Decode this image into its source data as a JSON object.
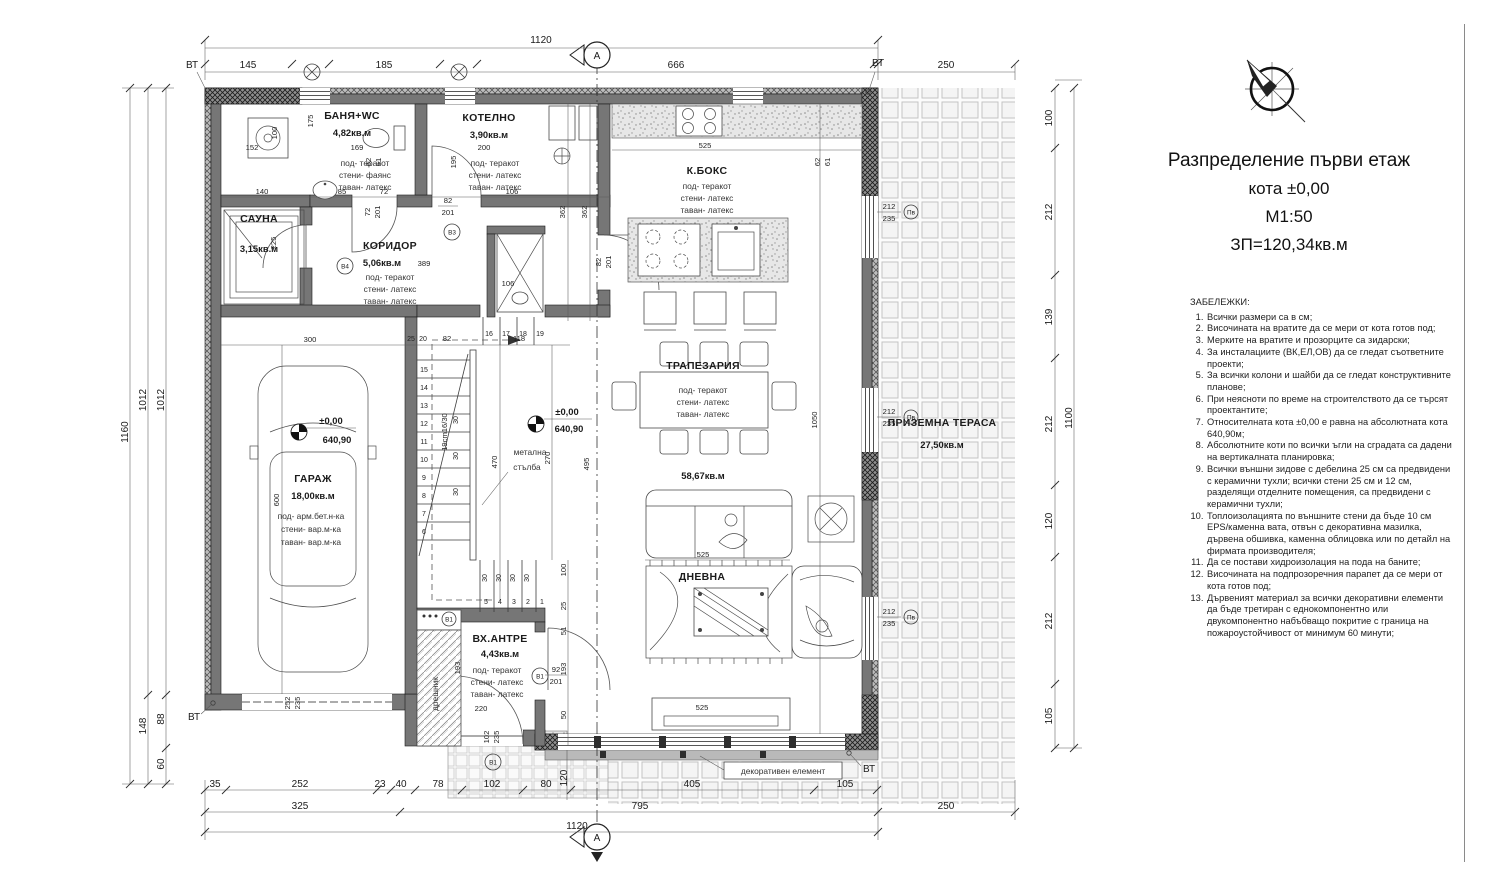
{
  "sheet": {
    "title1": "Разпределение първи етаж",
    "title2": "кота ±0,00",
    "title3": "М1:50",
    "title4": "ЗП=120,34кв.м"
  },
  "notes": {
    "heading": "ЗАБЕЛЕЖКИ:",
    "items": [
      "Всички размери са в см;",
      "Височината на вратите да се мери от кота готов под;",
      "Мерките на вратите и прозорците са зидарски;",
      "За инсталациите (ВК,ЕЛ,ОВ) да се гледат съответните проекти;",
      "За всички колони и шайби да се гледат конструктивните планове;",
      "При неясноти по време на строителството да се търсят проектантите;",
      "Относителната кота ±0,00 е равна на абсолютната кота 640,90м;",
      "Абсолютните коти по всички ъгли на сградата са дадени на вертикалната планировка;",
      "Всички външни зидове с дебелина 25 см са предвидени с керамични тухли; всички стени 25 см и 12 см, разделящи отделните помещения, са предвидени с керамични тухли;",
      "Топлоизолацията по външните стени да бъде 10 см EPS/каменна вата, отвън с декоративна мазилка, дървена обшивка, каменна облицовка или по детайл на фирмата производителя;",
      "Да се постави хидроизолация на пода на баните;",
      "Височината на подпрозоречния парапет да се мери от кота готов под;",
      "Дървеният материал за всички декоративни елементи да бъде третиран с еднокомпонентно или двукомпонентно набъбващо покритие с граница на пожароустойчивост от минимум 60 минути;"
    ]
  },
  "rooms": {
    "banya": {
      "name": "БАНЯ+WC",
      "area": "4,82кв.м",
      "f1": "под- теракот",
      "f2": "стени- фаянс",
      "f3": "таван- латекс"
    },
    "kotelno": {
      "name": "КОТЕЛНО",
      "area": "3,90кв.м",
      "f1": "под- теракот",
      "f2": "стени- латекс",
      "f3": "таван- латекс"
    },
    "sauna": {
      "name": "САУНА",
      "area": "3,15кв.м"
    },
    "koridor": {
      "name": "КОРИДОР",
      "area": "5,06кв.м",
      "extra": "389",
      "f1": "под- теракот",
      "f2": "стени- латекс",
      "f3": "таван- латекс"
    },
    "kboks": {
      "name": "К.БОКС",
      "f1": "под- теракот",
      "f2": "стени- латекс",
      "f3": "таван- латекс"
    },
    "trapezaria": {
      "name": "ТРАПЕЗАРИЯ",
      "f1": "под- теракот",
      "f2": "стени- латекс",
      "f3": "таван- латекс"
    },
    "living_area": "58,67кв.м",
    "dnevna": {
      "name": "ДНЕВНА"
    },
    "antre": {
      "name": "ВХ.АНТРЕ",
      "area": "4,43кв.м",
      "d220": "220",
      "f1": "под- теракот",
      "f2": "стени- латекс",
      "f3": "таван- латекс"
    },
    "garage": {
      "name": "ГАРАЖ",
      "area": "18,00кв.м",
      "f1": "под- арм.бет.н-ка",
      "f2": "стени- вар.м-ка",
      "f3": "таван- вар.м-ка"
    },
    "terasa": {
      "name": "ПРИЗЕМНА ТЕРАСА",
      "area": "27,50кв.м"
    }
  },
  "labels": {
    "stair1": "метална",
    "stair2": "стълба",
    "stair_spec": "19cm16/30",
    "closet": "дрешник",
    "decor": "декоративен елемент",
    "level_rel": "±0,00",
    "level_abs": "640,90",
    "vt": "ВТ",
    "section": "А"
  },
  "markers": {
    "v1": "В1",
    "v3": "В3",
    "v4": "В4",
    "pv": "Пв"
  },
  "fr": {
    "n212": "212",
    "n235": "235",
    "n92": "92",
    "n201": "201",
    "n102": "102",
    "n82": "82",
    "n72": "72",
    "n62": "62",
    "n61": "61",
    "n252": "252"
  },
  "dims": {
    "top": {
      "t1120": "1120",
      "t145": "145",
      "t185": "185",
      "t666": "666",
      "t250": "250"
    },
    "bottom": {
      "b35": "35",
      "b252": "252",
      "b23": "23",
      "b40": "40",
      "b78": "78",
      "b102": "102",
      "b80": "80",
      "b120": "120",
      "b405": "405",
      "b105": "105",
      "b325": "325",
      "b795": "795",
      "b1120": "1120",
      "b250": "250"
    },
    "left": {
      "l1160": "1160",
      "l1012": "1012",
      "l148": "148",
      "l88": "88",
      "l60": "60"
    },
    "right": {
      "r100": "100",
      "r212": "212",
      "r139": "139",
      "r120": "120",
      "r105": "105",
      "r1100": "1100"
    },
    "inner": {
      "i525": "525",
      "i362": "362",
      "i1050": "1050",
      "i470": "470",
      "i270": "270",
      "i495": "495",
      "i600": "600",
      "i300": "300",
      "i140": "140",
      "i85": "85",
      "i72": "72",
      "i106": "106",
      "i152": "152",
      "i169": "169",
      "i200": "200",
      "i195": "195",
      "i175": "175",
      "i100": "100",
      "i225": "225",
      "i118": "118",
      "i82": "82",
      "i25": "25",
      "i20": "20",
      "i51": "51",
      "i193": "193",
      "i50": "50",
      "i30": "30"
    }
  },
  "stairs": {
    "upper": [
      "15",
      "14",
      "13",
      "12",
      "11",
      "10",
      "9",
      "8",
      "7",
      "6"
    ],
    "lower": [
      "5",
      "4",
      "3",
      "2",
      "1"
    ],
    "top": [
      "16",
      "17",
      "18",
      "19"
    ]
  }
}
